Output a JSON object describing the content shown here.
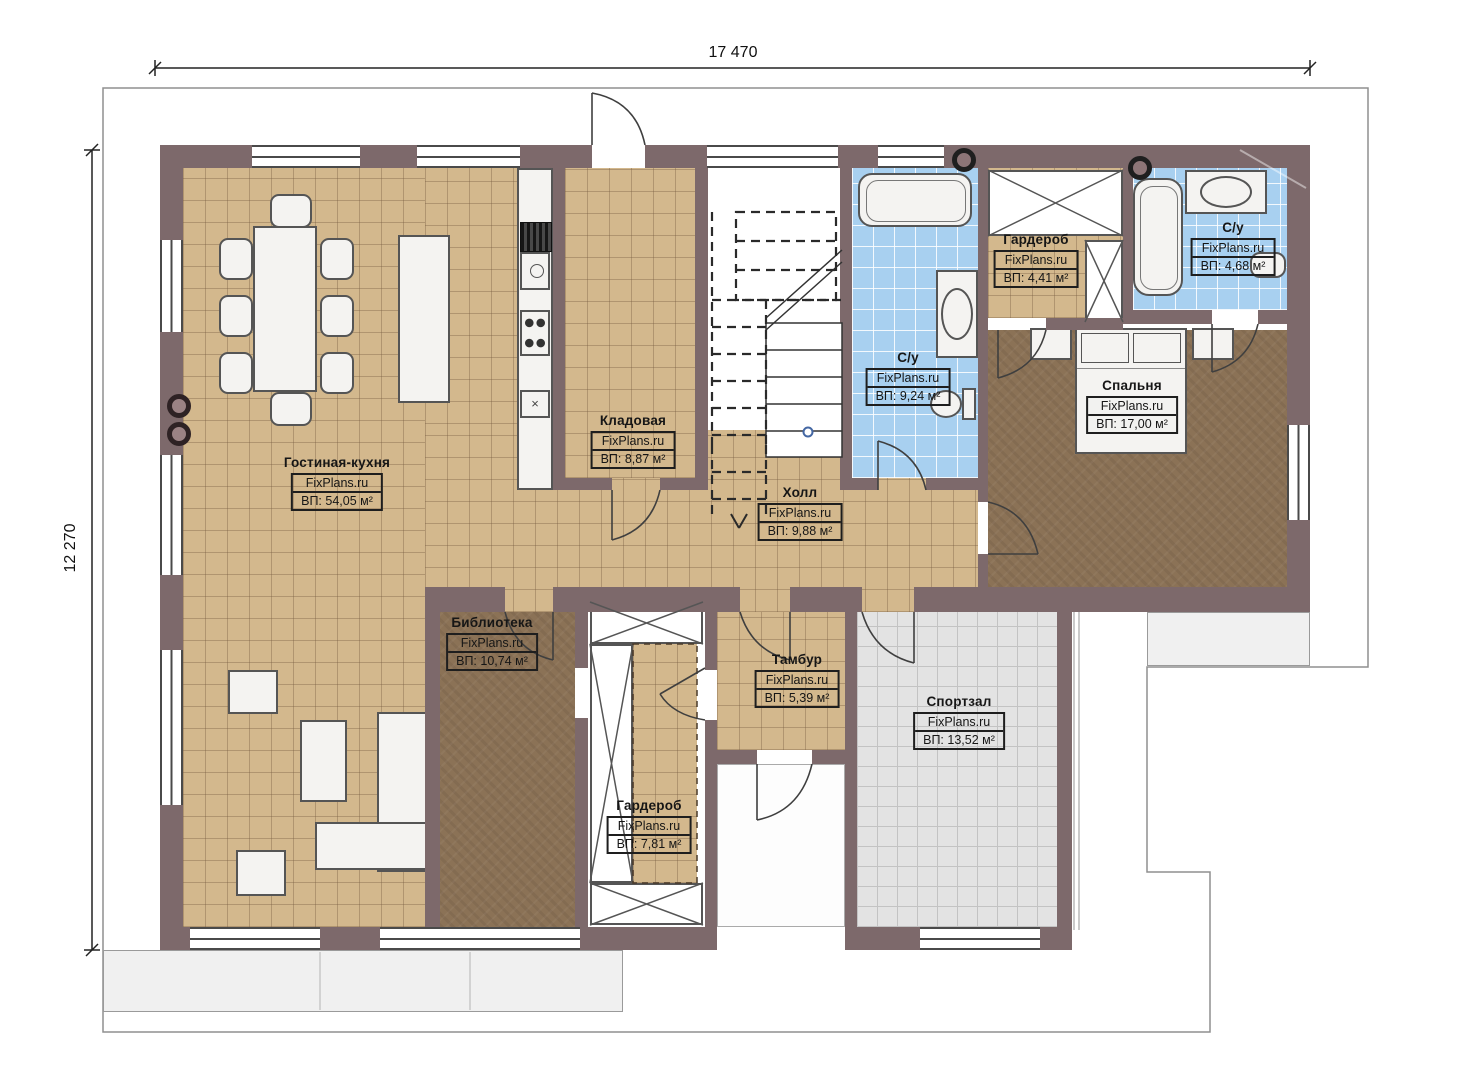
{
  "watermark": "FixPlans.ru",
  "dimensions": {
    "width": "17 470",
    "height": "12 270"
  },
  "rooms": {
    "living": {
      "name": "Гостиная-кухня",
      "area": "ВП: 54,05 м²"
    },
    "pantry": {
      "name": "Кладовая",
      "area": "ВП: 8,87 м²"
    },
    "hall": {
      "name": "Холл",
      "area": "ВП: 9,88 м²"
    },
    "bath_main": {
      "name": "С/у",
      "area": "ВП: 9,24 м²"
    },
    "wardrobe_top": {
      "name": "Гардероб",
      "area": "ВП: 4,41 м²"
    },
    "bath_small": {
      "name": "С/у",
      "area": "ВП: 4,68 м²"
    },
    "bedroom": {
      "name": "Спальня",
      "area": "ВП: 17,00 м²"
    },
    "library": {
      "name": "Библиотека",
      "area": "ВП: 10,74 м²"
    },
    "vestibule": {
      "name": "Тамбур",
      "area": "ВП: 5,39 м²"
    },
    "wardrobe_bottom": {
      "name": "Гардероб",
      "area": "ВП: 7,81 м²"
    },
    "gym": {
      "name": "Спортзал",
      "area": "ВП: 13,52 м²"
    }
  },
  "colors": {
    "wall": "#7d696b",
    "floor_tile": "#d3b88d",
    "floor_wet": "#a8d0f0",
    "floor_wood": "#8b7256",
    "floor_gym": "#e3e3e3",
    "terrace": "#f0f0f0"
  }
}
